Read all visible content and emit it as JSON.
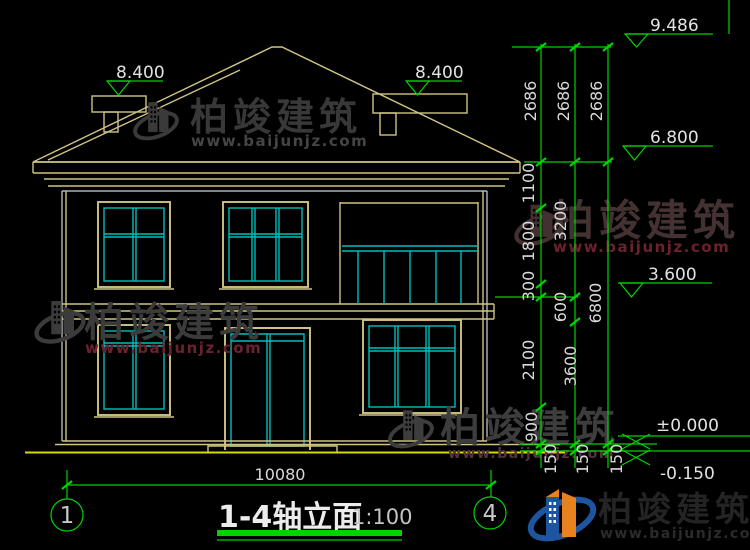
{
  "brand": {
    "name": "柏竣建筑",
    "url": "www.baijunjz.com"
  },
  "title_block": {
    "title": "1-4轴立面",
    "scale": "1:100"
  },
  "axis_bubbles": {
    "left": "1",
    "right": "4"
  },
  "levels": {
    "ridge": "9.486",
    "chimney_left": "8.400",
    "chimney_right": "8.400",
    "eave": "6.800",
    "floor2": "3.600",
    "ground": "±0.000",
    "foundation": "-0.150"
  },
  "dimensions": {
    "bottom_width": "10080",
    "col_a": [
      "2686",
      "1100",
      "1800",
      "300",
      "2100",
      "900",
      "150"
    ],
    "col_b": [
      "2686",
      "3200",
      "600",
      "3600",
      "150"
    ],
    "col_c": [
      "2686",
      "6800",
      "150"
    ]
  },
  "colors": {
    "dim_green": "#00d400",
    "outline_tan": "#cfc484",
    "glass_cyan": "#00bdbd",
    "wall_white": "#d4d4d4",
    "ground_yellow": "#d9d900",
    "logo_blue": "#1d55a0",
    "logo_orange": "#e8821e"
  }
}
